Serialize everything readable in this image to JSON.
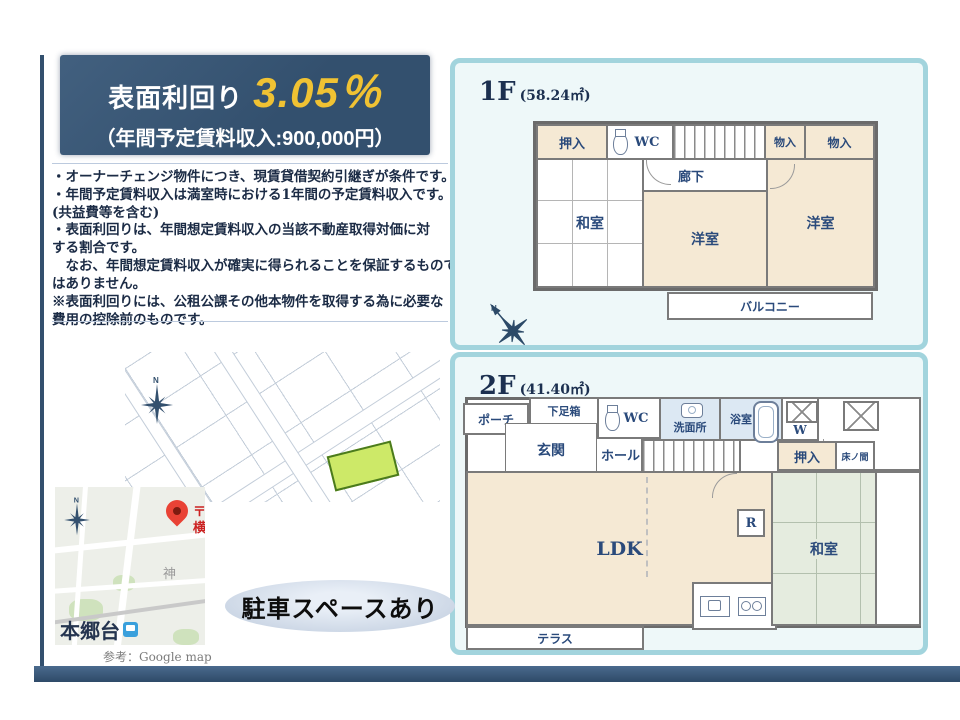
{
  "header": {
    "label": "表面利回り",
    "rate": "3.05％",
    "sub": "（年間予定賃料収入:900,000円）"
  },
  "notes": {
    "lines": [
      "・オーナーチェンジ物件につき、現賃貸借契約引継ぎが条件です。",
      "・年間予定賃料収入は満室時における1年間の予定賃料収入です。",
      "(共益費等を含む)",
      "・表面利回りは、年間想定賃料収入の当該不動産取得対価に対",
      "する割合です。",
      "　なお、年間想定賃料収入が確実に得られることを保証するもので",
      "はありません。",
      "※表面利回りには、公租公課その他本物件を取得する為に必要な",
      "費用の控除前のものです。"
    ]
  },
  "floor1": {
    "title": "1F",
    "area": "(58.24㎡)",
    "rooms": {
      "oshiire": "押入",
      "wc": "WC",
      "monoire1": "物入",
      "monoire2": "物入",
      "rouka": "廊下",
      "washitsu": "和室",
      "youshitsu_center": "洋室",
      "youshitsu_right": "洋室",
      "balcony": "バルコニー"
    }
  },
  "floor2": {
    "title": "2F",
    "area": "(41.40㎡)",
    "rooms": {
      "porch": "ポーチ",
      "shoebox": "下足箱",
      "wc": "WC",
      "senmenjo": "洗面所",
      "yokushitsu": "浴室",
      "washer": "W",
      "genkan": "玄関",
      "hall": "ホール",
      "rouka": "廊下",
      "oshiire": "押入",
      "tokonoma": "床ノ間",
      "ldk": "LDK",
      "fridge": "R",
      "washitsu": "和室",
      "terrace": "テラス"
    }
  },
  "badge": {
    "label": "駐車スペースあり"
  },
  "gmap": {
    "station": "本郷台",
    "caption": "参考：Google map",
    "pin_char1": "〒",
    "pin_char2": "横",
    "district": "神"
  },
  "compass": {
    "north": "N"
  },
  "colors": {
    "navy": "#33506e",
    "yellow": "#f0c233",
    "panel_border": "#a2d4dd",
    "panel_bg": "#eef8f9",
    "cream": "#f5e9d4",
    "tatami_green": "#e5ecdf",
    "wet_room": "#dce8f3",
    "parcel_green": "#cde968",
    "pin_red": "#e94235",
    "badge_bg": "#becbdd"
  }
}
